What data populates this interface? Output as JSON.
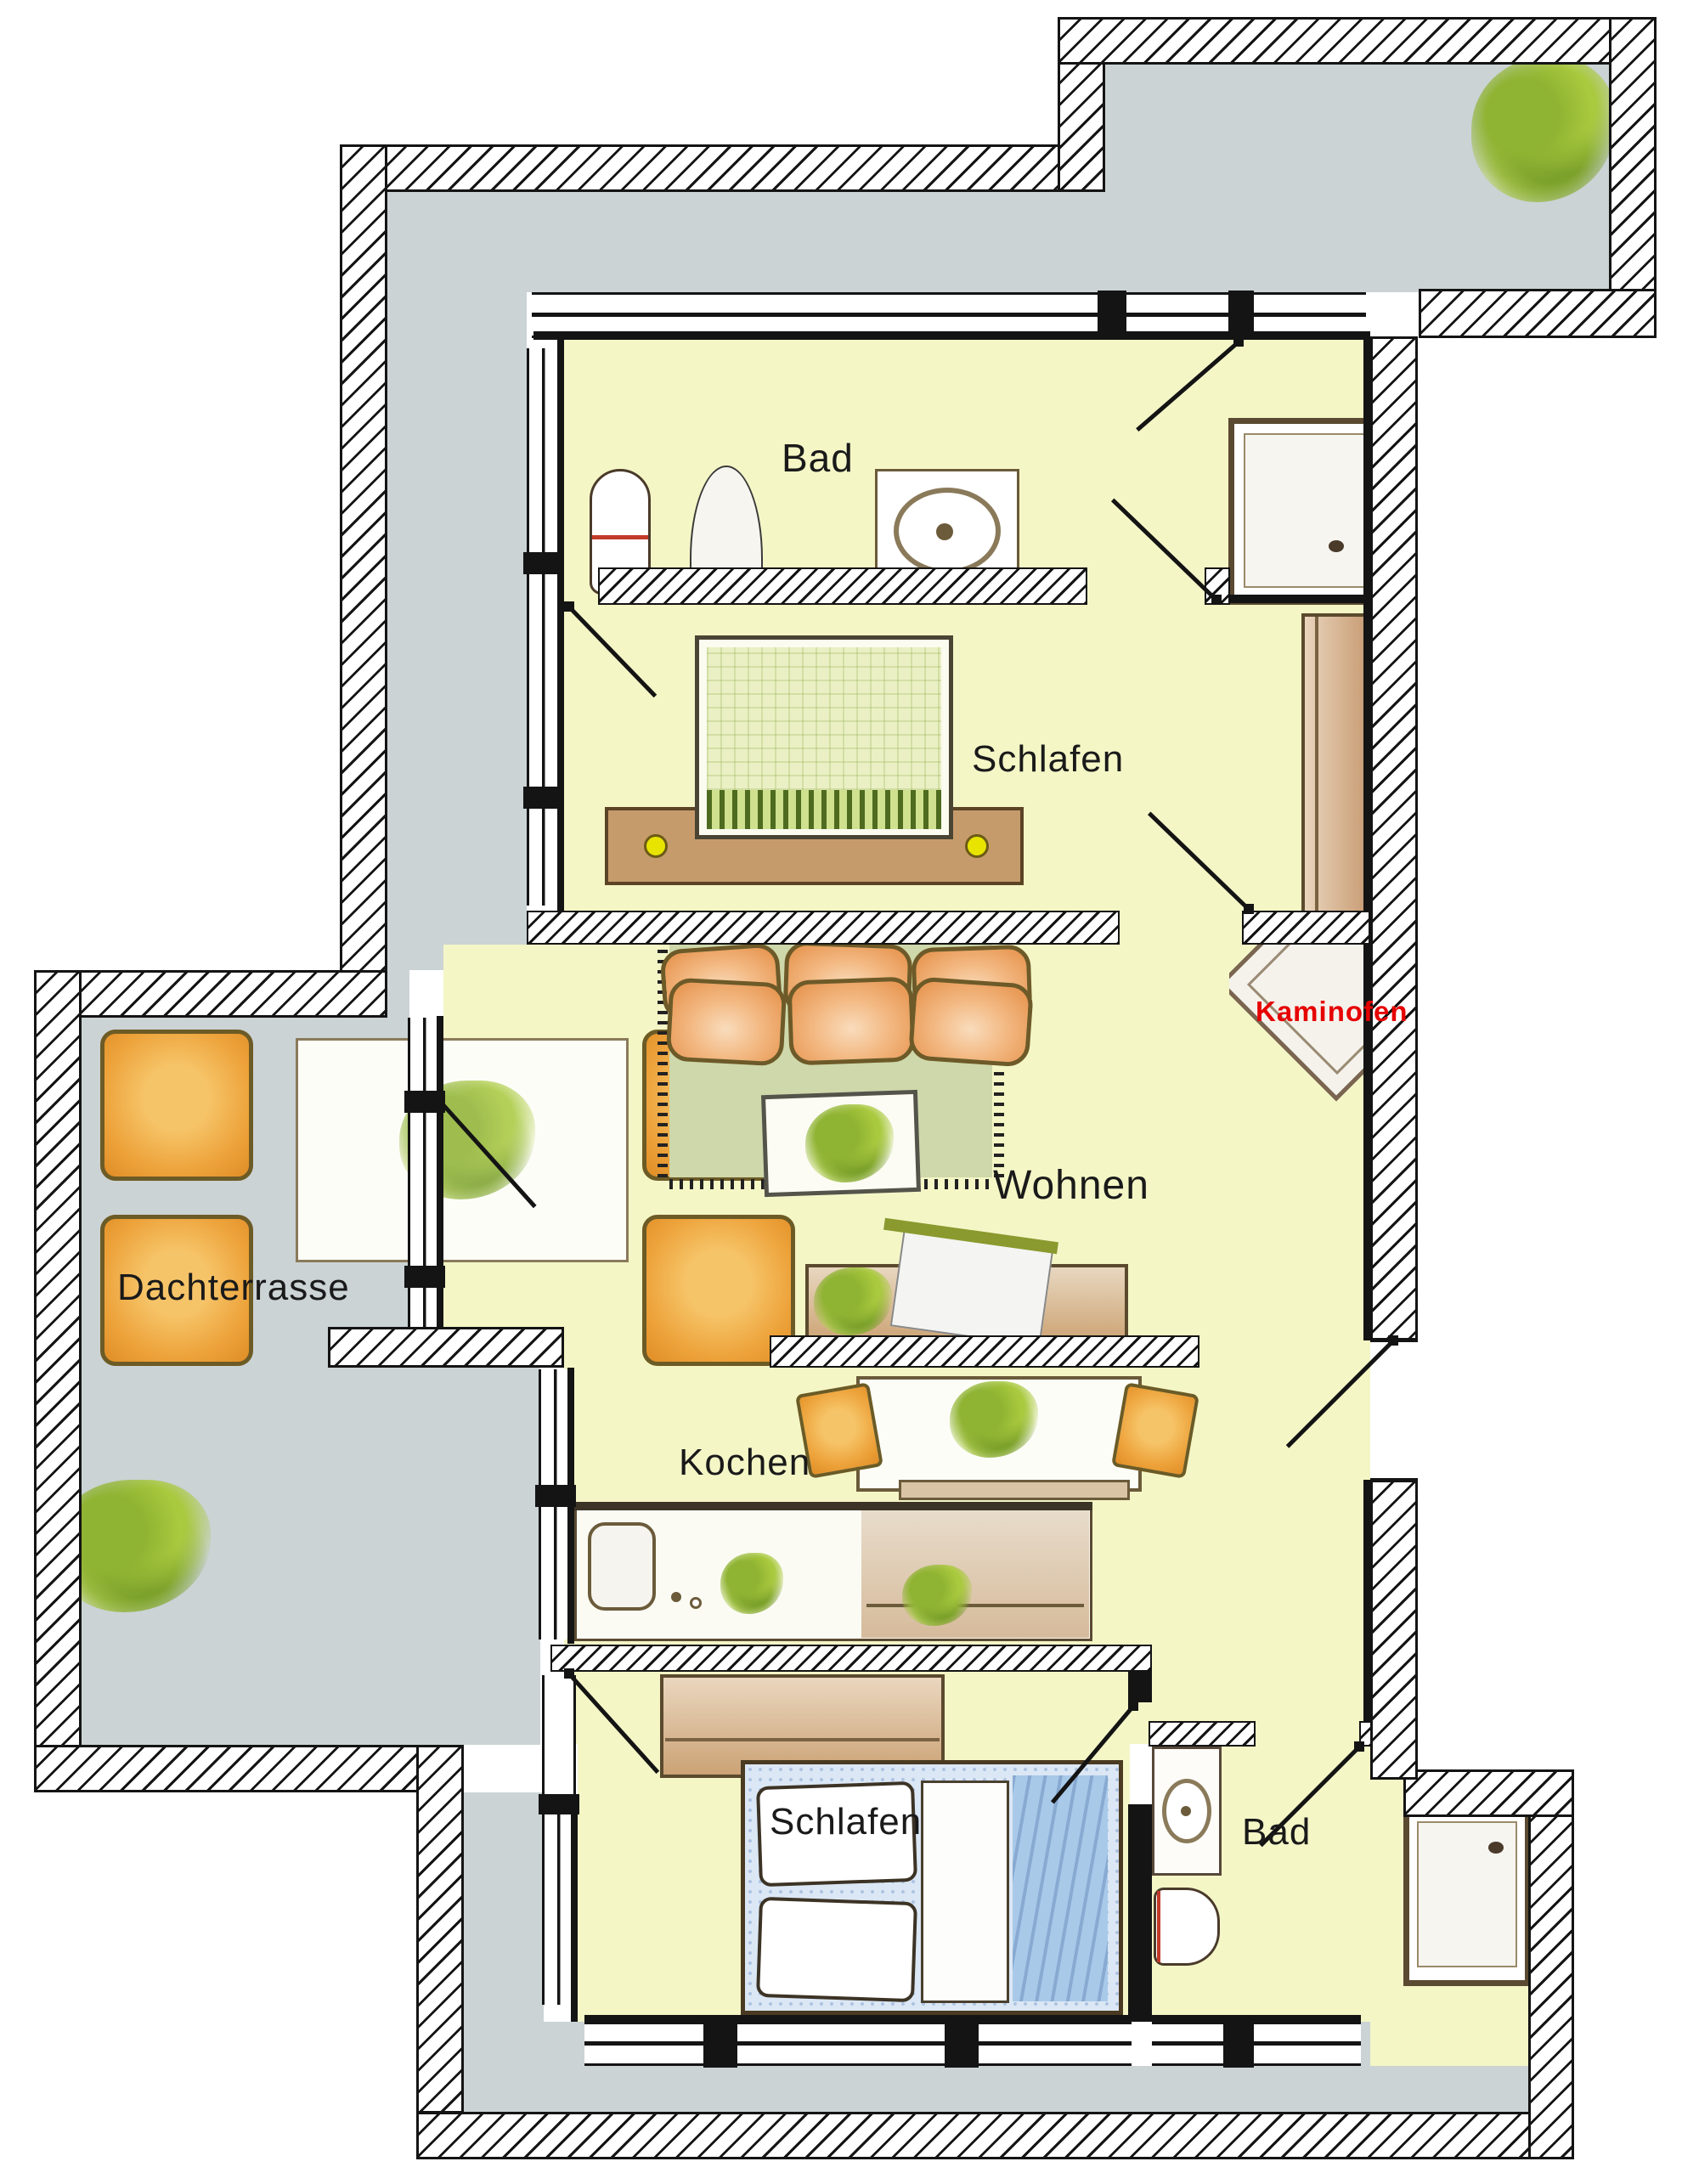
{
  "plan_type": "apartment-floor-plan",
  "rooms": [
    {
      "id": "bad-top",
      "label": "Bad"
    },
    {
      "id": "schlafen-top",
      "label": "Schlafen"
    },
    {
      "id": "wohnen",
      "label": "Wohnen"
    },
    {
      "id": "dachterrasse",
      "label": "Dachterrasse"
    },
    {
      "id": "kochen",
      "label": "Kochen"
    },
    {
      "id": "schlafen-bottom",
      "label": "Schlafen"
    },
    {
      "id": "bad-bottom",
      "label": "Bad"
    }
  ],
  "annotations": [
    {
      "id": "kaminofen",
      "label": "Kaminofen",
      "color": "#e60000"
    }
  ],
  "colors": {
    "room_fill": "#f4f6c6",
    "terrace_fill": "#cbd3d5",
    "wall_ink": "#141414",
    "rug": "#ced8aa",
    "sofa_orange": "#f3b983",
    "chair_orange": "#eda23a",
    "wood": "#cba275",
    "bed_blue": "#a9c9e9",
    "bed_green": "#eaf0c4",
    "annotation_red": "#e60000"
  }
}
